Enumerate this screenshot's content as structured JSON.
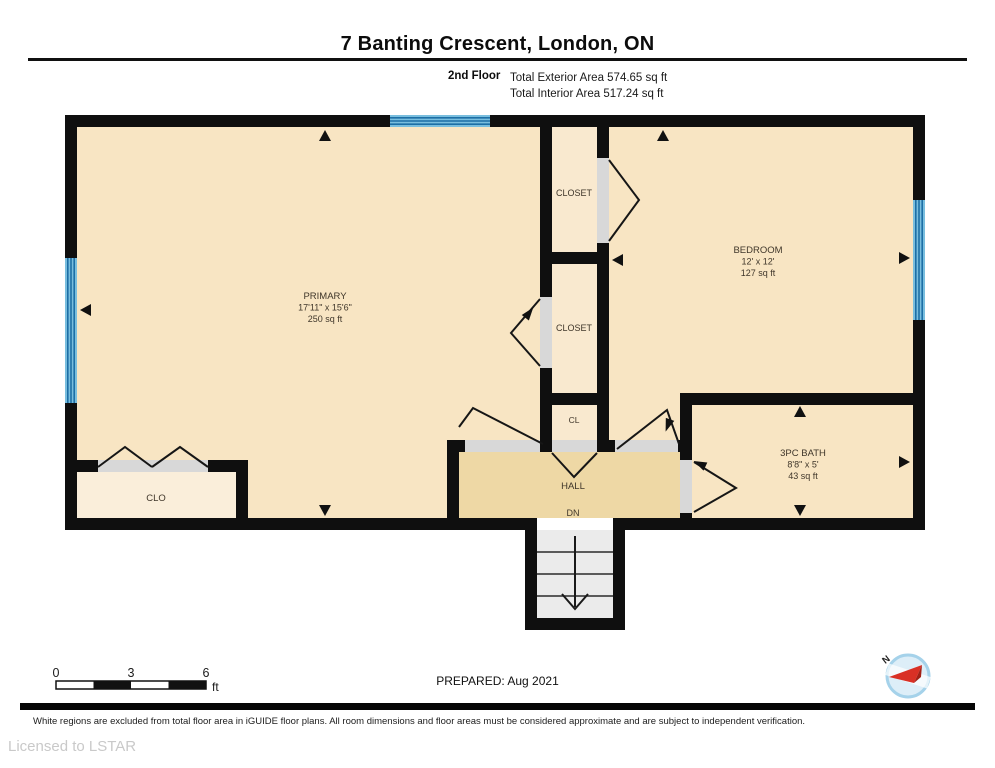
{
  "header": {
    "title": "7 Banting Crescent, London, ON",
    "floor_label": "2nd Floor",
    "exterior_area": "Total Exterior Area 574.65 sq ft",
    "interior_area": "Total Interior Area 517.24 sq ft"
  },
  "rooms": {
    "primary": {
      "name": "PRIMARY",
      "dims": "17'11\" x 15'6\"",
      "area": "250 sq ft"
    },
    "bedroom": {
      "name": "BEDROOM",
      "dims": "12' x 12'",
      "area": "127 sq ft"
    },
    "bath": {
      "name": "3PC BATH",
      "dims": "8'8\" x 5'",
      "area": "43 sq ft"
    },
    "closet_top": {
      "name": "CLOSET"
    },
    "closet_mid": {
      "name": "CLOSET"
    },
    "closet_small": {
      "name": "CL"
    },
    "closet_clo": {
      "name": "CLO"
    },
    "hall": {
      "name": "HALL",
      "stairs": "DN"
    }
  },
  "scale_bar": {
    "start": "0",
    "mid": "3",
    "end": "6",
    "unit": "ft"
  },
  "compass": {
    "label": "N"
  },
  "footer": {
    "prepared": "PREPARED: Aug 2021",
    "disclaimer": "White regions are excluded from total floor area in iGUIDE floor plans. All room dimensions and floor areas must be considered approximate and are subject to independent verification.",
    "license": "Licensed to LSTAR"
  },
  "colors": {
    "wall": "#0f0f0f",
    "room_fill": "#f8e5c3",
    "closet_fill": "#f9e9cf",
    "clo_fill": "#faeeda",
    "hall_fill": "#eed8a5",
    "window": "#79bede",
    "window_stripe": "#1d6fa5",
    "door_opening": "#d8d8d8",
    "stairs_fill": "#ebebeb",
    "compass_red": "#d93025"
  }
}
